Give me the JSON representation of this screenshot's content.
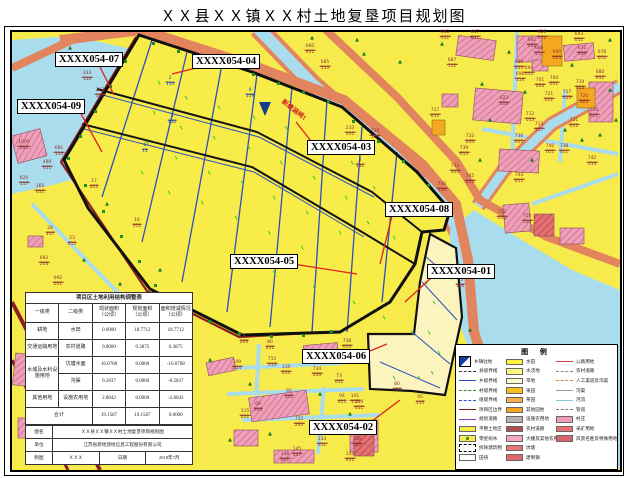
{
  "title": "ＸＸ县ＸＸ镇ＸＸ村土地复垦项目规划图",
  "map": {
    "river_label": "新建涵闸1",
    "plot_labels": [
      {
        "text": "XXXX054-07",
        "x": 43,
        "y": 20,
        "lx": 88,
        "ly": 35,
        "ex": 102,
        "ey": 63
      },
      {
        "text": "XXXX054-04",
        "x": 180,
        "y": 22,
        "lx": 184,
        "ly": 36,
        "ex": 160,
        "ey": 42
      },
      {
        "text": "XXXX054-09",
        "x": 5,
        "y": 67,
        "lx": 68,
        "ly": 80,
        "ex": 90,
        "ey": 120
      },
      {
        "text": "XXXX054-03",
        "x": 295,
        "y": 108,
        "lx": 299,
        "ly": 109,
        "ex": 284,
        "ey": 90
      },
      {
        "text": "XXXX054-08",
        "x": 373,
        "y": 170,
        "lx": 380,
        "ly": 184,
        "ex": 368,
        "ey": 232
      },
      {
        "text": "XXXX054-05",
        "x": 218,
        "y": 222,
        "lx": 281,
        "ly": 232,
        "ex": 345,
        "ey": 242
      },
      {
        "text": "XXXX054-01",
        "x": 415,
        "y": 232,
        "lx": 419,
        "ly": 246,
        "ex": 393,
        "ey": 270
      },
      {
        "text": "XXXX054-06",
        "x": 290,
        "y": 317,
        "lx": 353,
        "ly": 321,
        "ex": 375,
        "ey": 312
      },
      {
        "text": "XXXX054-02",
        "x": 297,
        "y": 388,
        "lx": 360,
        "ly": 389,
        "ex": 388,
        "ey": 368
      }
    ],
    "parcel_codes": [
      {
        "x": 75,
        "y": 45,
        "t": "333",
        "b": "114",
        "c": "r"
      },
      {
        "x": 88,
        "y": 62,
        "t": "203",
        "b": "104",
        "c": "r"
      },
      {
        "x": 47,
        "y": 120,
        "t": "681",
        "b": "114",
        "c": "r"
      },
      {
        "x": 35,
        "y": 134,
        "t": "499",
        "b": "011",
        "c": "r"
      },
      {
        "x": 12,
        "y": 114,
        "t": "1009",
        "b": "203",
        "c": "r"
      },
      {
        "x": 12,
        "y": 150,
        "t": "620",
        "b": "117",
        "c": "r"
      },
      {
        "x": 28,
        "y": 158,
        "t": "165",
        "b": "011",
        "c": "r"
      },
      {
        "x": 82,
        "y": 153,
        "t": "17",
        "b": "011",
        "c": "r"
      },
      {
        "x": 125,
        "y": 192,
        "t": "16",
        "b": "011",
        "c": "r"
      },
      {
        "x": 60,
        "y": 210,
        "t": "23",
        "b": "011",
        "c": "r"
      },
      {
        "x": 38,
        "y": 200,
        "t": "28",
        "b": "117",
        "c": "r"
      },
      {
        "x": 32,
        "y": 230,
        "t": "682",
        "b": "203",
        "c": "r"
      },
      {
        "x": 46,
        "y": 250,
        "t": "692",
        "b": "011",
        "c": "r"
      },
      {
        "x": 158,
        "y": 50,
        "t": "2",
        "b": "114",
        "c": "b"
      },
      {
        "x": 160,
        "y": 88,
        "t": "3",
        "b": "132",
        "c": "b"
      },
      {
        "x": 133,
        "y": 117,
        "t": "6",
        "b": "11",
        "c": "b"
      },
      {
        "x": 238,
        "y": 62,
        "t": "9",
        "b": "119",
        "c": "b"
      },
      {
        "x": 298,
        "y": 18,
        "t": "660",
        "b": "011",
        "c": "r"
      },
      {
        "x": 313,
        "y": 34,
        "t": "685",
        "b": "114",
        "c": "r"
      },
      {
        "x": 338,
        "y": 100,
        "t": "233",
        "b": "111",
        "c": "r"
      },
      {
        "x": 348,
        "y": 132,
        "t": "2",
        "b": "131",
        "c": "r"
      },
      {
        "x": 363,
        "y": 103,
        "t": "730",
        "b": "114",
        "c": "r"
      },
      {
        "x": 433,
        "y": 4,
        "t": "645",
        "b": "011",
        "c": "r"
      },
      {
        "x": 463,
        "y": 4,
        "t": "647",
        "b": "011",
        "c": "r"
      },
      {
        "x": 440,
        "y": 32,
        "t": "687",
        "b": "112",
        "c": "r"
      },
      {
        "x": 530,
        "y": 4,
        "t": "628",
        "b": "011",
        "c": "r"
      },
      {
        "x": 567,
        "y": 6,
        "t": "643",
        "b": "011",
        "c": "r"
      },
      {
        "x": 520,
        "y": 12,
        "t": "661",
        "b": "203",
        "c": "r"
      },
      {
        "x": 527,
        "y": 20,
        "t": "666",
        "b": "117",
        "c": "r"
      },
      {
        "x": 545,
        "y": 24,
        "t": "690",
        "b": "023",
        "c": "r"
      },
      {
        "x": 570,
        "y": 20,
        "t": "672",
        "b": "203",
        "c": "r"
      },
      {
        "x": 590,
        "y": 24,
        "t": "678",
        "b": "011",
        "c": "r"
      },
      {
        "x": 507,
        "y": 34,
        "t": "689",
        "b": "013",
        "c": "r"
      },
      {
        "x": 517,
        "y": 40,
        "t": "694",
        "b": "011",
        "c": "r"
      },
      {
        "x": 508,
        "y": 46,
        "t": "698",
        "b": "114",
        "c": "r"
      },
      {
        "x": 528,
        "y": 52,
        "t": "701",
        "b": "203",
        "c": "r"
      },
      {
        "x": 542,
        "y": 50,
        "t": "704",
        "b": "011",
        "c": "r"
      },
      {
        "x": 568,
        "y": 54,
        "t": "719",
        "b": "013",
        "c": "r"
      },
      {
        "x": 572,
        "y": 68,
        "t": "720",
        "b": "023",
        "c": "r"
      },
      {
        "x": 537,
        "y": 66,
        "t": "721",
        "b": "011",
        "c": "r"
      },
      {
        "x": 555,
        "y": 64,
        "t": "717",
        "b": "013",
        "c": "r"
      },
      {
        "x": 588,
        "y": 44,
        "t": "680",
        "b": "011",
        "c": "r"
      },
      {
        "x": 492,
        "y": 70,
        "t": "623",
        "b": "203",
        "c": "r"
      },
      {
        "x": 518,
        "y": 86,
        "t": "712",
        "b": "013",
        "c": "r"
      },
      {
        "x": 527,
        "y": 96,
        "t": "713",
        "b": "117",
        "c": "r"
      },
      {
        "x": 582,
        "y": 82,
        "t": "726",
        "b": "011",
        "c": "r"
      },
      {
        "x": 562,
        "y": 92,
        "t": "731",
        "b": "011",
        "c": "r"
      },
      {
        "x": 507,
        "y": 108,
        "t": "736",
        "b": "011",
        "c": "r"
      },
      {
        "x": 423,
        "y": 82,
        "t": "727",
        "b": "011",
        "c": "r"
      },
      {
        "x": 458,
        "y": 108,
        "t": "732",
        "b": "203",
        "c": "r"
      },
      {
        "x": 452,
        "y": 120,
        "t": "739",
        "b": "013",
        "c": "r"
      },
      {
        "x": 538,
        "y": 118,
        "t": "740",
        "b": "011",
        "c": "r"
      },
      {
        "x": 552,
        "y": 118,
        "t": "738",
        "b": "011",
        "c": "r"
      },
      {
        "x": 580,
        "y": 130,
        "t": "742",
        "b": "114",
        "c": "r"
      },
      {
        "x": 507,
        "y": 147,
        "t": "744",
        "b": "011",
        "c": "r"
      },
      {
        "x": 458,
        "y": 148,
        "t": "745",
        "b": "011",
        "c": "r"
      },
      {
        "x": 443,
        "y": 138,
        "t": "743",
        "b": "203",
        "c": "r"
      },
      {
        "x": 430,
        "y": 156,
        "t": "740",
        "b": "114",
        "c": "r"
      },
      {
        "x": 490,
        "y": 184,
        "t": "732",
        "b": "011",
        "c": "r"
      },
      {
        "x": 515,
        "y": 188,
        "t": "753",
        "b": "114",
        "c": "r"
      },
      {
        "x": 448,
        "y": 252,
        "t": "15",
        "b": "116",
        "c": "r"
      },
      {
        "x": 232,
        "y": 308,
        "t": "8",
        "b": "203",
        "c": "r"
      },
      {
        "x": 258,
        "y": 314,
        "t": "80",
        "b": "011",
        "c": "r"
      },
      {
        "x": 335,
        "y": 313,
        "t": "738",
        "b": "013",
        "c": "r"
      },
      {
        "x": 260,
        "y": 331,
        "t": "715",
        "b": "113",
        "c": "r"
      },
      {
        "x": 305,
        "y": 341,
        "t": "734",
        "b": "203",
        "c": "r"
      },
      {
        "x": 327,
        "y": 348,
        "t": "73",
        "b": "011",
        "c": "r"
      },
      {
        "x": 274,
        "y": 339,
        "t": "119",
        "b": "013",
        "c": "r"
      },
      {
        "x": 225,
        "y": 334,
        "t": "109",
        "b": "114",
        "c": "r"
      },
      {
        "x": 277,
        "y": 363,
        "t": "92",
        "b": "011",
        "c": "r"
      },
      {
        "x": 330,
        "y": 368,
        "t": "94",
        "b": "011",
        "c": "r"
      },
      {
        "x": 343,
        "y": 368,
        "t": "101",
        "b": "117",
        "c": "r"
      },
      {
        "x": 347,
        "y": 374,
        "t": "139",
        "b": "011",
        "c": "r"
      },
      {
        "x": 233,
        "y": 383,
        "t": "115",
        "b": "011",
        "c": "r"
      },
      {
        "x": 246,
        "y": 376,
        "t": "66",
        "b": "203",
        "c": "r"
      },
      {
        "x": 287,
        "y": 391,
        "t": "722",
        "b": "203",
        "c": "r"
      },
      {
        "x": 310,
        "y": 411,
        "t": "133",
        "b": "011",
        "c": "r"
      },
      {
        "x": 345,
        "y": 411,
        "t": "136",
        "b": "203",
        "c": "r"
      },
      {
        "x": 285,
        "y": 421,
        "t": "145",
        "b": "117",
        "c": "r"
      },
      {
        "x": 273,
        "y": 426,
        "t": "148",
        "b": "011",
        "c": "r"
      },
      {
        "x": 338,
        "y": 426,
        "t": "142",
        "b": "011",
        "c": "r"
      },
      {
        "x": 385,
        "y": 356,
        "t": "80",
        "b": "114",
        "c": "r"
      },
      {
        "x": 408,
        "y": 369,
        "t": "95",
        "b": "115",
        "c": "r"
      },
      {
        "x": 85,
        "y": 386,
        "t": "121",
        "b": "011",
        "c": "r"
      },
      {
        "x": 90,
        "y": 426,
        "t": "174",
        "b": "011",
        "c": "r"
      },
      {
        "x": 70,
        "y": 408,
        "t": "135",
        "b": "011",
        "c": "r"
      }
    ]
  },
  "table": {
    "title": "项目区土地利用结构调整表",
    "headers": [
      "一级类",
      "二级类",
      "现状面积\n（公顷）",
      "规划面积\n（公顷）",
      "面积增减情况\n（公顷）"
    ],
    "rows": [
      [
        "耕地",
        "水田",
        "0.0000",
        "18.7712",
        "18.7712"
      ],
      [
        "交通运输用地",
        "农村道路",
        "0.0000",
        "0.3875",
        "0.3875"
      ],
      [
        "水域及水利设施用地",
        "坑塘水面",
        "16.0708",
        "0.0000",
        "-16.0708"
      ],
      [
        "沟渠",
        "0.2837",
        "0.0000",
        "-0.2837"
      ],
      [
        "其他用地",
        "设施农用地",
        "2.8042",
        "0.0000",
        "-2.8042"
      ]
    ],
    "total_label": "合计",
    "total": [
      "19.1587",
      "19.1587",
      "0.0000"
    ]
  },
  "signature": {
    "row1_label": "图名",
    "row1_value": "ＸＸ县ＸＸ镇ＸＸ村土地复垦项目规划图",
    "row2_label": "单位",
    "row2_value": "江苏省新地测绘信息工程股份有限公司",
    "row3_cells": [
      "制图",
      "ＸＸＸ",
      "日期",
      "2018年7月"
    ]
  },
  "legend": {
    "title": "图 例",
    "left": [
      {
        "k": "seat",
        "label": "乡镇驻地"
      },
      {
        "k": "lnd",
        "c": "#333333",
        "label": "县级界线"
      },
      {
        "k": "lns",
        "c": "#2B50C0",
        "label": "乡级界线"
      },
      {
        "k": "lnd",
        "c": "#2E8B2E",
        "label": "村级界线"
      },
      {
        "k": "lnd",
        "c": "#2B50C0",
        "label": "组级界线"
      },
      {
        "k": "lns",
        "c": "#8B1E1E",
        "label": "项目区边界"
      },
      {
        "k": "lns",
        "c": "#8040C0",
        "label": "规划道路"
      },
      {
        "k": "sw",
        "c": "#F8EC48",
        "label": "平整土地区"
      },
      {
        "k": "swd",
        "c": "#F8EC48",
        "label": "零星树木"
      },
      {
        "k": "dr0",
        "label": "拆除建筑物"
      },
      {
        "k": "sw",
        "c": "#FFFFFF",
        "label": "田块"
      }
    ],
    "middle": [
      {
        "k": "sw",
        "c": "#FFF23F",
        "label": "水田"
      },
      {
        "k": "sw",
        "c": "#FDF680",
        "label": "水浇地"
      },
      {
        "k": "sw",
        "c": "#FEFAD0",
        "label": "旱地"
      },
      {
        "k": "sw",
        "c": "#F7C11E",
        "label": "果园"
      },
      {
        "k": "sw",
        "c": "#F6B24A",
        "label": "茶园"
      },
      {
        "k": "sw",
        "c": "#F5A623",
        "label": "其他园地"
      },
      {
        "k": "sw",
        "c": "#B9AFB9",
        "label": "设施农用地"
      },
      {
        "k": "sw",
        "c": "#B05050",
        "label": "农村道路"
      },
      {
        "k": "sw",
        "c": "#F6A8C0",
        "label": "大棚及其他农用地"
      },
      {
        "k": "sw",
        "c": "#E87878",
        "label": "坑塘"
      },
      {
        "k": "sw",
        "c": "#E06868",
        "label": "建制镇"
      }
    ],
    "right": [
      {
        "k": "lns",
        "c": "#D04040",
        "label": "公路用地"
      },
      {
        "k": "lnd",
        "c": "#888888",
        "label": "农村道路"
      },
      {
        "k": "lnx",
        "c": "#E08030",
        "label": "人工渠道及沟渠"
      },
      {
        "k": "lns",
        "c": "#999999",
        "label": "沟渠"
      },
      {
        "k": "lns",
        "c": "#7FC8DC",
        "label": "河流"
      },
      {
        "k": "lnd",
        "c": "#777777",
        "label": "管道"
      },
      {
        "k": "sw",
        "c": "#F09CB4",
        "label": "村庄"
      },
      {
        "k": "sw",
        "c": "#E87070",
        "label": "采矿用地"
      },
      {
        "k": "sw",
        "c": "#D86470",
        "label": "风景名胜及特殊用地"
      }
    ]
  }
}
